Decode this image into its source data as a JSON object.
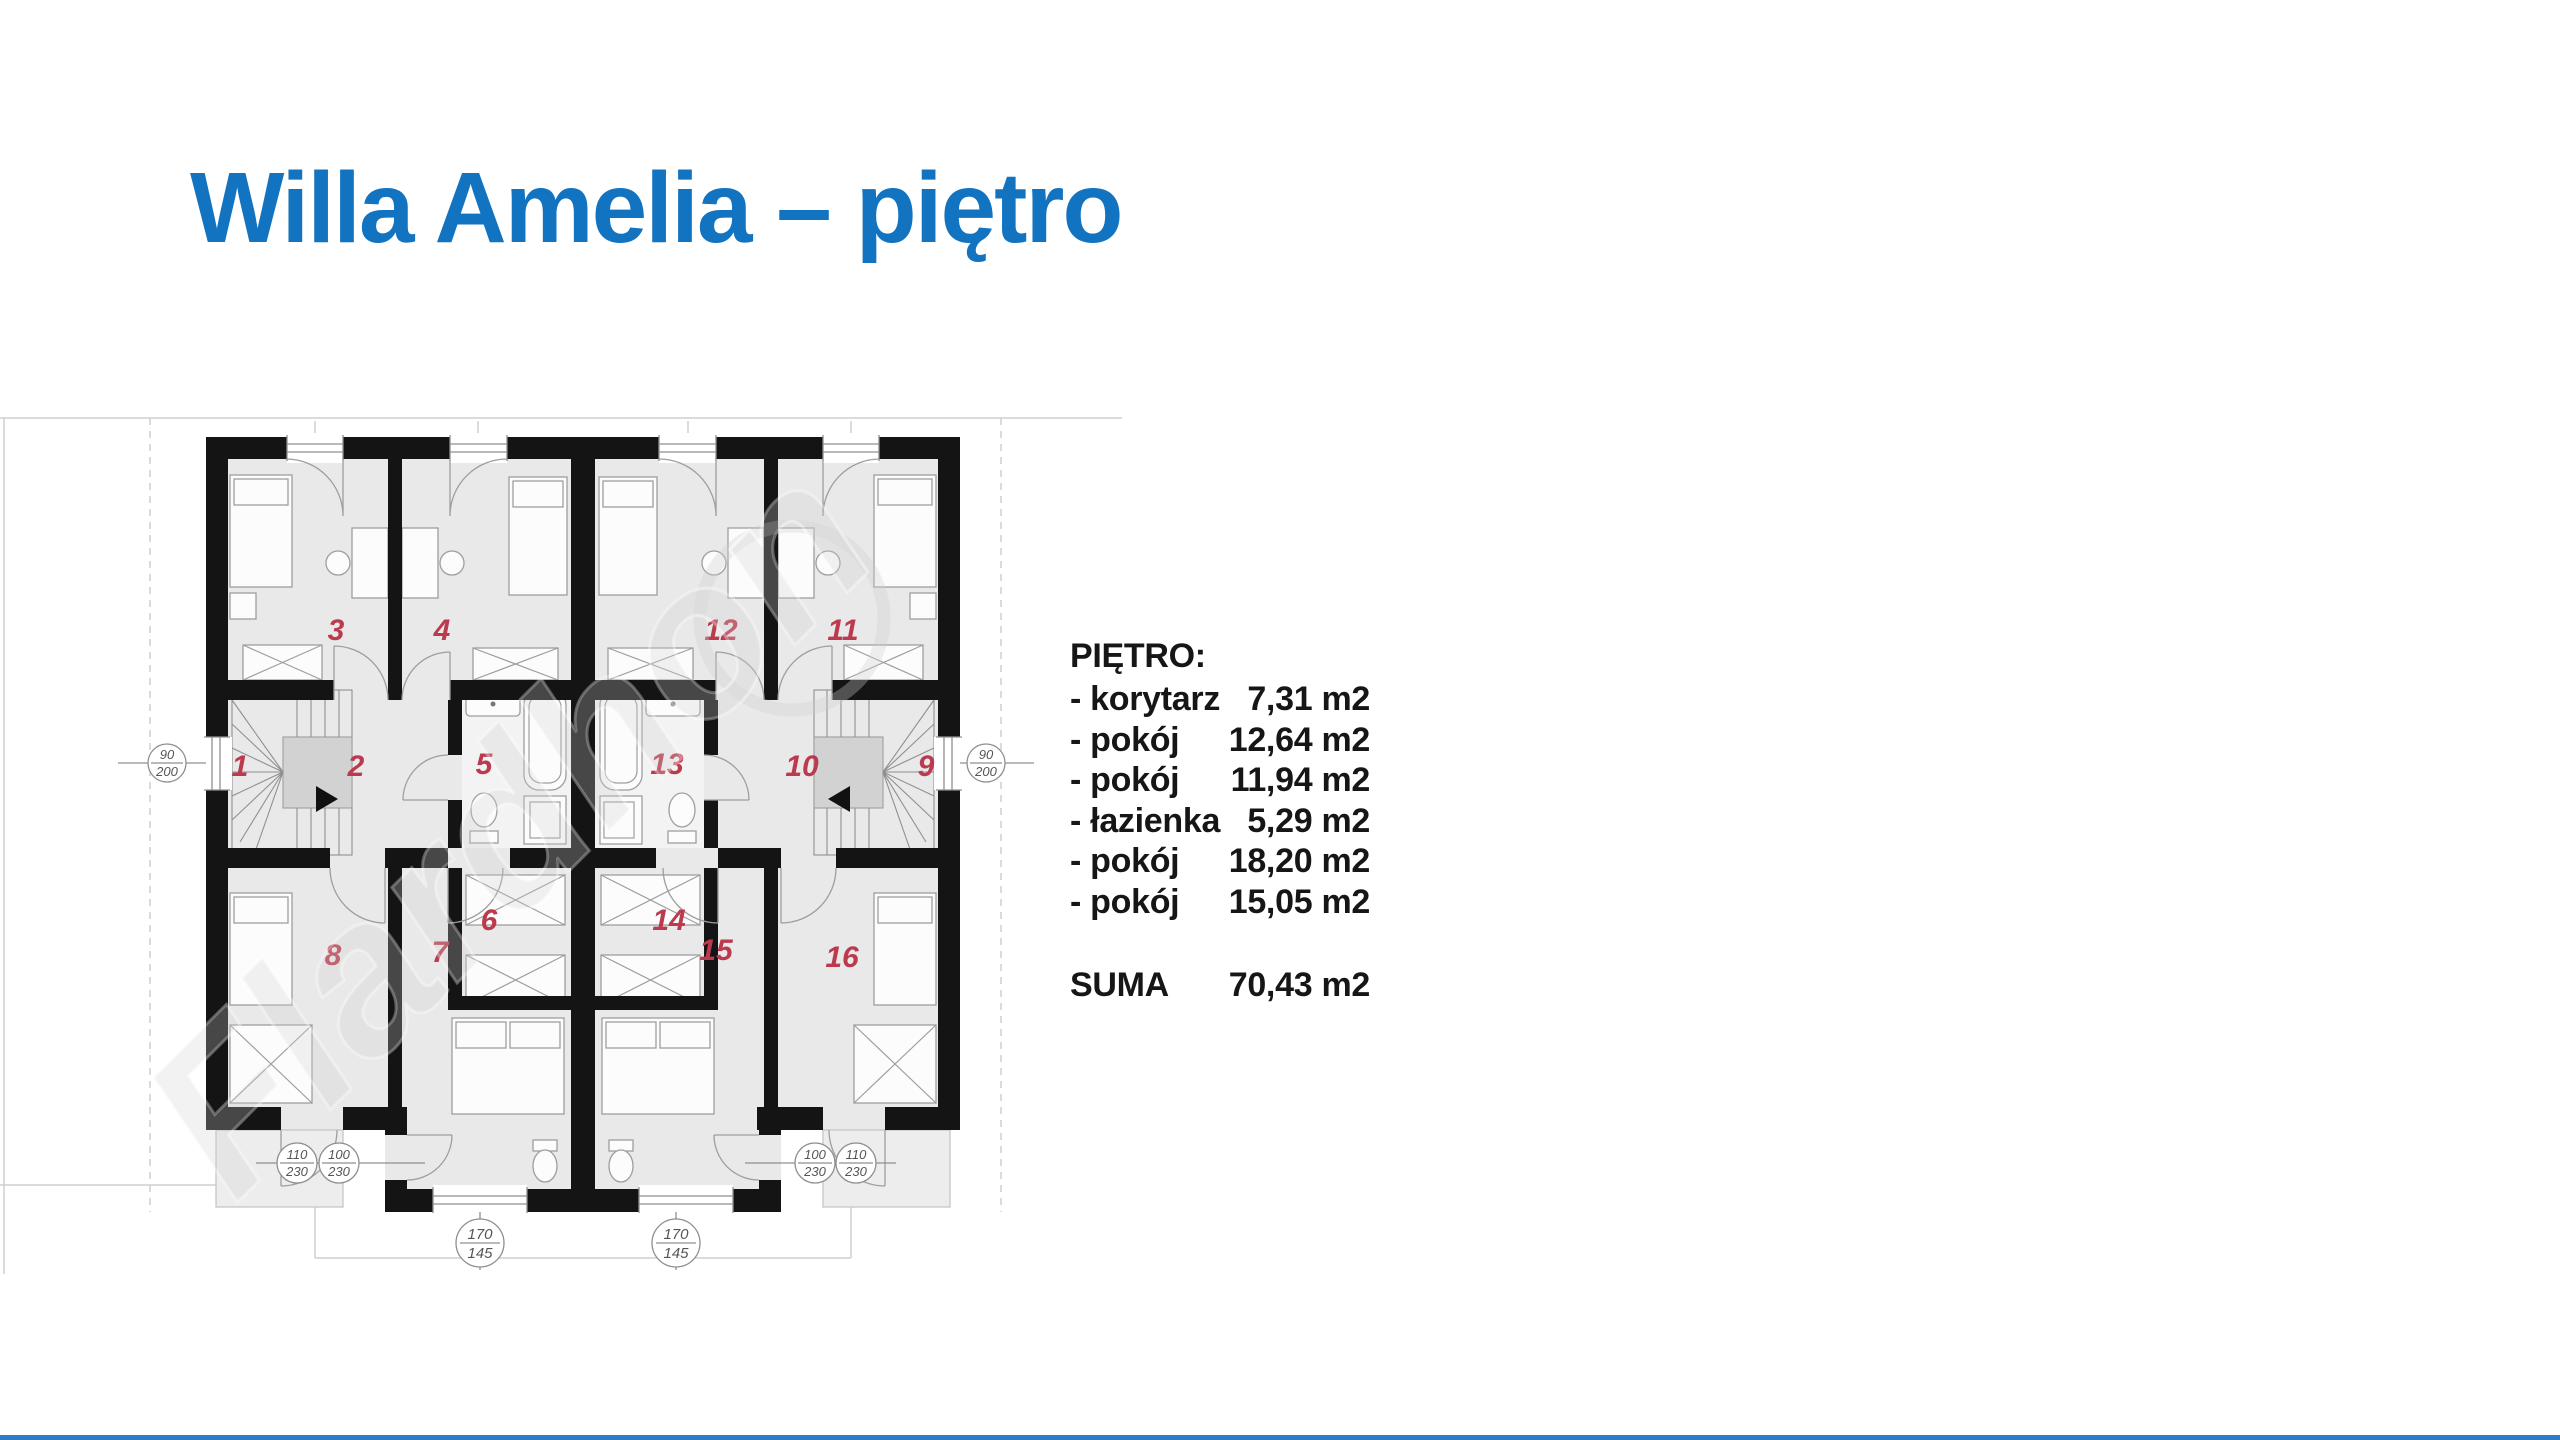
{
  "slide": {
    "title": "Willa Amelia – piętro",
    "title_color": "#1273c0",
    "accent_line_color": "#2a7cc7"
  },
  "areas": {
    "heading": "PIĘTRO:",
    "items": [
      {
        "label": "- korytarz",
        "value": "7,31 m2"
      },
      {
        "label": "- pokój",
        "value": "12,64 m2"
      },
      {
        "label": "- pokój",
        "value": "11,94 m2"
      },
      {
        "label": "- łazienka",
        "value": "5,29 m2"
      },
      {
        "label": "- pokój",
        "value": "18,20 m2"
      },
      {
        "label": "- pokój",
        "value": "15,05 m2"
      }
    ],
    "total_label": "SUMA",
    "total_value": "70,43 m2"
  },
  "floorplan": {
    "number_color": "#bc3a4e",
    "rooms": [
      "1",
      "2",
      "3",
      "4",
      "5",
      "6",
      "7",
      "8",
      "9",
      "10",
      "11",
      "12",
      "13",
      "14",
      "15",
      "16"
    ],
    "dims": [
      {
        "id": "left-window",
        "top": "90",
        "bottom": "200"
      },
      {
        "id": "right-window",
        "top": "90",
        "bottom": "200"
      },
      {
        "id": "bottom-left-outer",
        "top": "110",
        "bottom": "230"
      },
      {
        "id": "bottom-left-inner",
        "top": "100",
        "bottom": "230"
      },
      {
        "id": "bottom-right-inner",
        "top": "100",
        "bottom": "230"
      },
      {
        "id": "bottom-right-outer",
        "top": "110",
        "bottom": "230"
      },
      {
        "id": "bottom-center-left",
        "top": "170",
        "bottom": "145"
      },
      {
        "id": "bottom-center-right",
        "top": "170",
        "bottom": "145"
      }
    ],
    "watermark": "Flardhon"
  }
}
